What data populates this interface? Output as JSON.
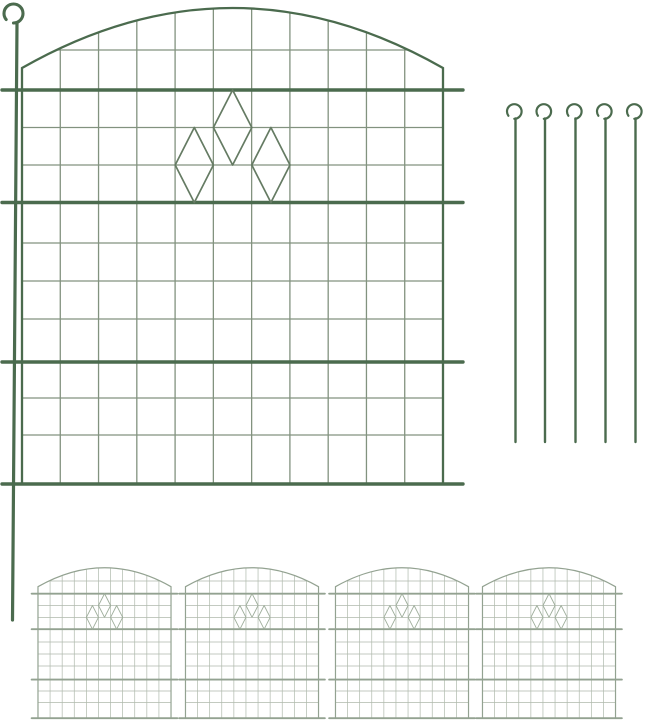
{
  "image": {
    "kind": "product-illustration",
    "subject": "decorative garden border fence panel set with ground anchor stakes",
    "width": 645,
    "height": 720,
    "background": "#ffffff"
  },
  "palette": {
    "frame_green": "#4b6b4e",
    "wire_green": "#82927f",
    "diamond_green": "#657b63",
    "small_frame": "#93a291",
    "small_wire": "#afb9ac",
    "small_diamond": "#9fae9c"
  },
  "main_panel": {
    "left": 22,
    "right": 443,
    "bottom": 484,
    "arch_side_y": 68,
    "arch_ctrl_y": -52,
    "columns": 11,
    "thin_rows": [
      50,
      127.5,
      165,
      243,
      281,
      319,
      398,
      435
    ],
    "thick_rows": [
      90,
      202.5,
      362,
      484
    ],
    "overhang": 20,
    "diamonds": [
      {
        "cx": 232.6,
        "top": 90,
        "bottom": 165,
        "hw": 19.2
      },
      {
        "cx": 194.3,
        "top": 127.5,
        "bottom": 202.5,
        "hw": 19.1
      },
      {
        "cx": 270.9,
        "top": 127.5,
        "bottom": 202.5,
        "hw": 19.1
      }
    ],
    "stroke_widths": {
      "thin": 1.3,
      "edge": 2.3,
      "thick": 3.4,
      "diamond": 1.7
    }
  },
  "attached_stake": {
    "loop": {
      "cx": 13.5,
      "cy": 13.5,
      "r": 9.5,
      "width": 3.1,
      "dash": "86 14",
      "dash_offset": 61
    },
    "rod": {
      "x1": 17,
      "y1": 23,
      "x2": 12.5,
      "y2": 620,
      "width": 3.2
    }
  },
  "anchor_stakes": {
    "count": 5,
    "rod_x": [
      515.5,
      545,
      575.5,
      605.5,
      635.5
    ],
    "loop_cy": 111.5,
    "loop_r": 7.3,
    "loop_dx": -1.2,
    "loop_width": 2.2,
    "loop_dash": "85 15",
    "loop_dash_offset": 60,
    "rod_top": 118.5,
    "rod_bottom": 442,
    "rod_width": 2.4
  },
  "preview_row": {
    "count": 4,
    "scale": 0.316,
    "centers_x": [
      104.5,
      252,
      402,
      549
    ],
    "top_y": 565.2,
    "stroke_widths": {
      "thin": 0.7,
      "edge": 1.2,
      "thick": 1.9,
      "diamond": 0.9
    }
  }
}
